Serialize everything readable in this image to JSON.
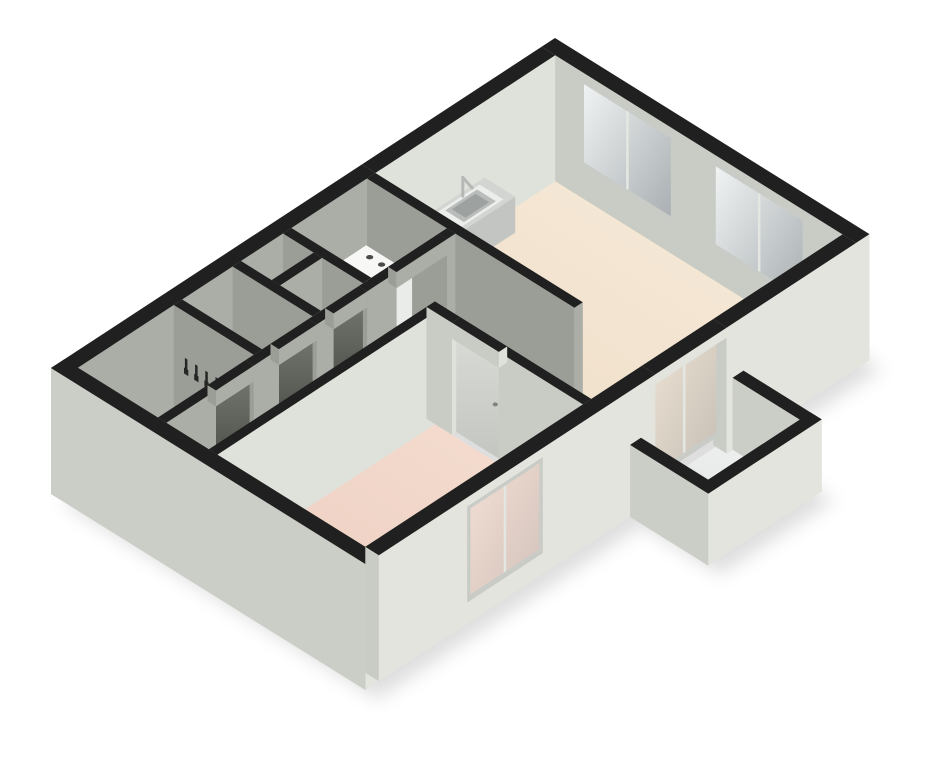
{
  "scene": {
    "title": "3d-isometric-floor-plan",
    "description": "One-bedroom apartment 3D floor plan: living room with kitchen counter and sink, bedroom, hallway, bathroom, WC, utility closet with washing machine, coat hooks, balcony with parapet, glass windows and sliding doors, black wall tops",
    "background": "#ffffff",
    "width": 925,
    "height": 768
  },
  "projection": {
    "origin": [
      555,
      38
    ],
    "axis_e": [
      0.85,
      0.53
    ],
    "axis_s": [
      -0.84,
      0.55
    ],
    "wall_height": 112,
    "ground": -14,
    "shadow_offset": [
      12,
      9
    ]
  },
  "palette": {
    "black": "#1f201f",
    "extEast": "#e2e4dd",
    "extSouth": "#cbcec6",
    "intSouthLit": "#c9ccc5",
    "intSouthDim": "#9b9e97",
    "intEastLit": "#dfe2db",
    "intEastDim": "#aaaea7",
    "counterTop": "#d2d5d2",
    "counterS": "#aeb1ae",
    "counterE": "#c2c5c2",
    "whiteTop": "#f7f8f6",
    "whiteS": "#dcdedb",
    "whiteE": "#eaecea",
    "sinkOuter": "#eceeec",
    "sinkMid": "#b9bcba",
    "sinkInner": "#9da19f",
    "frame": "#c9ccc6",
    "mullion": "#e4e6e1",
    "doorLightHandle": "#80837d",
    "hook": "#262725",
    "knob": "#4a4c49",
    "faucet": "#b5b8b5",
    "shadow": "rgba(0,0,0,0.13)"
  },
  "gradients": {
    "floorLiving": {
      "from": "#f8ecdb",
      "to": "#eddcc6",
      "x1": 1,
      "y1": 0,
      "x2": 0,
      "y2": 1
    },
    "floorBed": {
      "from": "#f5ded1",
      "to": "#ebccbe",
      "x1": 1,
      "y1": 0,
      "x2": 0,
      "y2": 1
    },
    "floorHall": {
      "from": "#c6c7c1",
      "to": "#9da09a",
      "x1": 1,
      "y1": 0,
      "x2": 0,
      "y2": 1
    },
    "floorCorr": {
      "from": "#b4b5af",
      "to": "#8e918a",
      "x1": 1,
      "y1": 0,
      "x2": 0,
      "y2": 1
    },
    "floorWest": {
      "from": "#aaaca6",
      "to": "#7f827c",
      "x1": 1,
      "y1": 0,
      "x2": 0,
      "y2": 1
    },
    "floorBalc": {
      "from": "#f3f4f3",
      "to": "#dfe2e2",
      "x1": 1,
      "y1": 0,
      "x2": 0,
      "y2": 1
    },
    "glassWin": {
      "from": "#f0f3f3",
      "to": "#a9afb2",
      "x1": 0,
      "y1": 0,
      "x2": 1,
      "y2": 1
    },
    "glassBalc": {
      "from": "#ece2d4",
      "to": "#c6beb4",
      "x1": 0,
      "y1": 0,
      "x2": 1,
      "y2": 1
    },
    "glassBed": {
      "from": "#f3dfd4",
      "to": "#d2c2bb",
      "x1": 0,
      "y1": 0,
      "x2": 1,
      "y2": 1
    },
    "doorDark": {
      "from": "#72756d",
      "to": "#3d403b",
      "x1": 0,
      "y1": 0,
      "x2": 0,
      "y2": 1
    },
    "doorLight": {
      "from": "#d8dbd5",
      "to": "#c3c6c0",
      "x1": 0,
      "y1": 0,
      "x2": 0,
      "y2": 1
    }
  },
  "footprint": [
    [
      0,
      0
    ],
    [
      370,
      0
    ],
    [
      370,
      150
    ],
    [
      462,
      150
    ],
    [
      462,
      285
    ],
    [
      370,
      285
    ],
    [
      370,
      600
    ],
    [
      0,
      600
    ]
  ],
  "paint": [
    {
      "op": "shadow",
      "name": "building-drop-shadow"
    },
    {
      "op": "floor",
      "name": "living-room-floor",
      "rect": [
        16,
        16,
        354,
        230
      ],
      "fill": "g:floorLiving"
    },
    {
      "op": "floor",
      "name": "living-room-floor-extension",
      "rect": [
        260,
        230,
        354,
        315
      ],
      "fill": "g:floorLiving"
    },
    {
      "op": "floor",
      "name": "hallway-floor",
      "rect": [
        120,
        240,
        260,
        315
      ],
      "fill": "g:floorHall"
    },
    {
      "op": "floor",
      "name": "corridor-floor",
      "rect": [
        120,
        315,
        170,
        584
      ],
      "fill": "g:floorCorr"
    },
    {
      "op": "floor",
      "name": "utility-closet-floor",
      "rect": [
        16,
        240,
        110,
        330
      ],
      "fill": "g:floorWest"
    },
    {
      "op": "floor",
      "name": "storage-closet-floor",
      "rect": [
        16,
        340,
        110,
        390
      ],
      "fill": "g:floorWest"
    },
    {
      "op": "floor",
      "name": "wc-floor",
      "rect": [
        16,
        400,
        110,
        460
      ],
      "fill": "g:floorWest"
    },
    {
      "op": "floor",
      "name": "bathroom-floor",
      "rect": [
        16,
        470,
        110,
        584
      ],
      "fill": "g:floorWest"
    },
    {
      "op": "floor",
      "name": "bedroom-floor",
      "rect": [
        180,
        325,
        354,
        584
      ],
      "fill": "g:floorBed"
    },
    {
      "op": "floor",
      "name": "balcony-floor",
      "rect": [
        370,
        150,
        462,
        285
      ],
      "fill": "g:floorBalc"
    },
    {
      "op": "wall",
      "name": "north-facade-wall",
      "rect": [
        0,
        0,
        370,
        16
      ],
      "h": 112,
      "z0": -14,
      "top": "black",
      "s": "intSouthLit",
      "e": "extEast"
    },
    {
      "op": "window",
      "name": "living-room-window-1",
      "plane": "s",
      "at": 15,
      "range": [
        45,
        155
      ],
      "z": [
        16,
        104
      ],
      "frame": "frame",
      "glass": "g:glassWin",
      "mullion": "mullion"
    },
    {
      "op": "window",
      "name": "living-room-window-2",
      "plane": "s",
      "at": 15,
      "range": [
        200,
        310
      ],
      "z": [
        16,
        104
      ],
      "frame": "frame",
      "glass": "g:glassWin",
      "mullion": "mullion"
    },
    {
      "op": "wall",
      "name": "west-facade-wall-kitchen",
      "rect": [
        0,
        16,
        16,
        230
      ],
      "h": 112,
      "z0": -14,
      "top": "black",
      "s": "extSouth",
      "e": "intEastLit"
    },
    {
      "op": "wall",
      "name": "west-facade-wall-south",
      "rect": [
        0,
        230,
        16,
        600
      ],
      "h": 112,
      "z0": -14,
      "top": "black",
      "s": "extSouth",
      "e": "intEastDim"
    },
    {
      "op": "box",
      "name": "kitchen-counter",
      "rect": [
        16,
        100,
        52,
        200
      ],
      "h": 36,
      "z0": 0,
      "top": "counterTop",
      "s": "counterS",
      "e": "counterE"
    },
    {
      "op": "sinkTop",
      "name": "kitchen-sink",
      "h": 36.5,
      "rects": [
        {
          "rect": [
            20,
            110,
            48,
            160
          ],
          "fill": "sinkOuter"
        },
        {
          "rect": [
            23,
            116,
            45,
            154
          ],
          "fill": "sinkMid"
        },
        {
          "rect": [
            26,
            121,
            42,
            149
          ],
          "fill": "sinkInner"
        }
      ]
    },
    {
      "op": "faucet",
      "name": "kitchen-faucet",
      "pts": [
        [
          22,
          132,
          38
        ],
        [
          22,
          132,
          57
        ],
        [
          33,
          132,
          52
        ]
      ],
      "color": "faucet",
      "w": 3
    },
    {
      "op": "wall",
      "name": "living-south-wall",
      "rect": [
        16,
        230,
        260,
        240
      ],
      "h": 112,
      "z0": 0,
      "top": "black",
      "s": "intSouthDim",
      "e": "intEastDim"
    },
    {
      "op": "box",
      "name": "washing-machine",
      "rect": [
        20,
        245,
        74,
        300
      ],
      "h": 50,
      "z0": 0,
      "top": "whiteTop",
      "s": "whiteS",
      "e": "whiteE"
    },
    {
      "op": "knobs",
      "name": "washing-machine-knobs",
      "points": [
        [
          33,
          254
        ],
        [
          47,
          254
        ]
      ],
      "h": 50,
      "rx": 3.6,
      "ry": 2.2,
      "fill": "knob"
    },
    {
      "op": "wall",
      "name": "utility-south-wall",
      "rect": [
        16,
        330,
        110,
        340
      ],
      "h": 112,
      "z0": 0,
      "top": "black",
      "s": "intSouthDim",
      "e": "intEastDim"
    },
    {
      "op": "wall",
      "name": "closet-divider-wall",
      "rect": [
        52,
        340,
        62,
        390
      ],
      "h": 112,
      "z0": 0,
      "top": "black",
      "s": "intSouthDim",
      "e": "intEastDim"
    },
    {
      "op": "wall",
      "name": "closet-south-wall",
      "rect": [
        16,
        390,
        110,
        400
      ],
      "h": 112,
      "z0": 0,
      "top": "black",
      "s": "intSouthDim",
      "e": "intEastDim"
    },
    {
      "op": "box",
      "name": "wc-sink",
      "rect": [
        18,
        398,
        46,
        426
      ],
      "h": 32,
      "z0": 0,
      "top": "whiteTop",
      "s": "whiteS",
      "e": "whiteE"
    },
    {
      "op": "wall",
      "name": "wc-south-wall",
      "rect": [
        16,
        460,
        110,
        470
      ],
      "h": 112,
      "z0": 0,
      "top": "black",
      "s": "intSouthDim",
      "e": "intEastDim"
    },
    {
      "op": "hooks",
      "name": "coat-hooks",
      "plane": "s",
      "at": 471,
      "positions": [
        30,
        42,
        54,
        66,
        78
      ],
      "fill": "hook"
    },
    {
      "op": "wall",
      "name": "west-rooms-east-wall-1",
      "rect": [
        110,
        240,
        120,
        250
      ],
      "h": 112,
      "z0": 0,
      "top": "black",
      "s": "intSouthDim",
      "e": "intEastDim"
    },
    {
      "op": "wall",
      "name": "west-rooms-east-wall-2",
      "rect": [
        110,
        310,
        120,
        345
      ],
      "h": 112,
      "z0": 0,
      "top": "black",
      "s": "intSouthDim",
      "e": "intEastDim"
    },
    {
      "op": "door",
      "name": "closet-door",
      "plane": "e",
      "at": 115,
      "range": [
        345,
        385
      ],
      "z": [
        0,
        96
      ],
      "fill": "g:doorDark"
    },
    {
      "op": "wall",
      "name": "west-rooms-east-wall-3",
      "rect": [
        110,
        385,
        120,
        405
      ],
      "h": 112,
      "z0": 0,
      "top": "black",
      "s": "intSouthDim",
      "e": "intEastDim"
    },
    {
      "op": "door",
      "name": "wc-door",
      "plane": "e",
      "at": 115,
      "range": [
        405,
        450
      ],
      "z": [
        0,
        96
      ],
      "fill": "g:doorDark"
    },
    {
      "op": "wall",
      "name": "west-rooms-east-wall-4",
      "rect": [
        110,
        450,
        120,
        480
      ],
      "h": 112,
      "z0": 0,
      "top": "black",
      "s": "intSouthDim",
      "e": "intEastDim"
    },
    {
      "op": "door",
      "name": "bathroom-door",
      "plane": "e",
      "at": 115,
      "range": [
        480,
        525
      ],
      "z": [
        0,
        96
      ],
      "fill": "g:doorDark"
    },
    {
      "op": "wall",
      "name": "west-rooms-east-wall-5",
      "rect": [
        110,
        525,
        120,
        584
      ],
      "h": 112,
      "z0": 0,
      "top": "black",
      "s": "intSouthDim",
      "e": "intEastDim"
    },
    {
      "op": "wall",
      "name": "lintel-utility-opening",
      "rect": [
        110,
        250,
        120,
        310
      ],
      "h": 112,
      "z0": 96,
      "top": "black",
      "s": "intSouthDim",
      "e": "intEastDim"
    },
    {
      "op": "wall",
      "name": "lintel-closet-door",
      "rect": [
        110,
        345,
        120,
        385
      ],
      "h": 112,
      "z0": 96,
      "top": "black",
      "s": "intSouthDim",
      "e": "intEastDim"
    },
    {
      "op": "wall",
      "name": "lintel-wc-door",
      "rect": [
        110,
        405,
        120,
        450
      ],
      "h": 112,
      "z0": 96,
      "top": "black",
      "s": "intSouthDim",
      "e": "intEastDim"
    },
    {
      "op": "wall",
      "name": "lintel-bathroom-door",
      "rect": [
        110,
        480,
        120,
        525
      ],
      "h": 112,
      "z0": 96,
      "top": "black",
      "s": "intSouthDim",
      "e": "intEastDim"
    },
    {
      "op": "wall",
      "name": "bedroom-west-wall",
      "rect": [
        170,
        325,
        180,
        584
      ],
      "h": 112,
      "z0": 0,
      "top": "black",
      "s": "intSouthDim",
      "e": "intEastLit"
    },
    {
      "op": "wall",
      "name": "bedroom-north-wall-west",
      "rect": [
        170,
        315,
        200,
        325
      ],
      "h": 112,
      "z0": 0,
      "top": "black",
      "s": "intSouthLit",
      "e": "intEastLit"
    },
    {
      "op": "door",
      "name": "bedroom-door",
      "plane": "s",
      "at": 320,
      "range": [
        200,
        255
      ],
      "z": [
        0,
        96
      ],
      "fill": "g:doorLight",
      "handle": true
    },
    {
      "op": "wall",
      "name": "bedroom-north-wall-east",
      "rect": [
        255,
        315,
        354,
        325
      ],
      "h": 112,
      "z0": 0,
      "top": "black",
      "s": "intSouthLit",
      "e": "intEastLit"
    },
    {
      "op": "wall",
      "name": "lintel-bedroom-door",
      "rect": [
        200,
        315,
        255,
        325
      ],
      "h": 112,
      "z0": 96,
      "top": "black",
      "s": "intSouthLit",
      "e": "intEastLit"
    },
    {
      "op": "wall",
      "name": "south-facade-wall",
      "rect": [
        0,
        584,
        370,
        600
      ],
      "h": 112,
      "z0": -14,
      "top": "black",
      "s": "extSouth",
      "e": "extEast"
    },
    {
      "op": "wall",
      "name": "east-facade-wall-north",
      "rect": [
        354,
        16,
        370,
        170
      ],
      "h": 112,
      "z0": -14,
      "top": "black",
      "s": "intSouthLit",
      "e": "extEast"
    },
    {
      "op": "wall",
      "name": "balcony-parapet-north",
      "rect": [
        370,
        150,
        462,
        163
      ],
      "h": 58,
      "z0": -14,
      "top": "black",
      "s": "extSouth",
      "e": "extEast"
    },
    {
      "op": "window",
      "name": "balcony-sliding-door",
      "plane": "e",
      "at": 362,
      "range": [
        170,
        255
      ],
      "z": [
        0,
        102
      ],
      "frame": "frame",
      "glass": "g:glassBalc",
      "mullion": "mullion"
    },
    {
      "op": "wall",
      "name": "lintel-balcony-door",
      "rect": [
        354,
        170,
        370,
        255
      ],
      "h": 112,
      "z0": 102,
      "top": "black",
      "s": "intSouthLit",
      "e": "extEast"
    },
    {
      "op": "wall",
      "name": "east-facade-wall-south",
      "rect": [
        354,
        255,
        370,
        584
      ],
      "h": 112,
      "z0": -14,
      "top": "black",
      "s": "intSouthLit",
      "e": "extEast"
    },
    {
      "op": "window",
      "name": "bedroom-window",
      "plane": "e",
      "at": 371,
      "range": [
        390,
        480
      ],
      "z": [
        8,
        104
      ],
      "frame": "frame",
      "glass": "g:glassBed",
      "mullion": "mullion"
    },
    {
      "op": "wall",
      "name": "balcony-parapet-east",
      "rect": [
        449,
        150,
        462,
        285
      ],
      "h": 58,
      "z0": -14,
      "top": "black",
      "s": "extSouth",
      "e": "extEast"
    },
    {
      "op": "wall",
      "name": "balcony-parapet-south",
      "rect": [
        370,
        272,
        462,
        285
      ],
      "h": 58,
      "z0": -14,
      "top": "black",
      "s": "extSouth",
      "e": "extEast"
    }
  ]
}
